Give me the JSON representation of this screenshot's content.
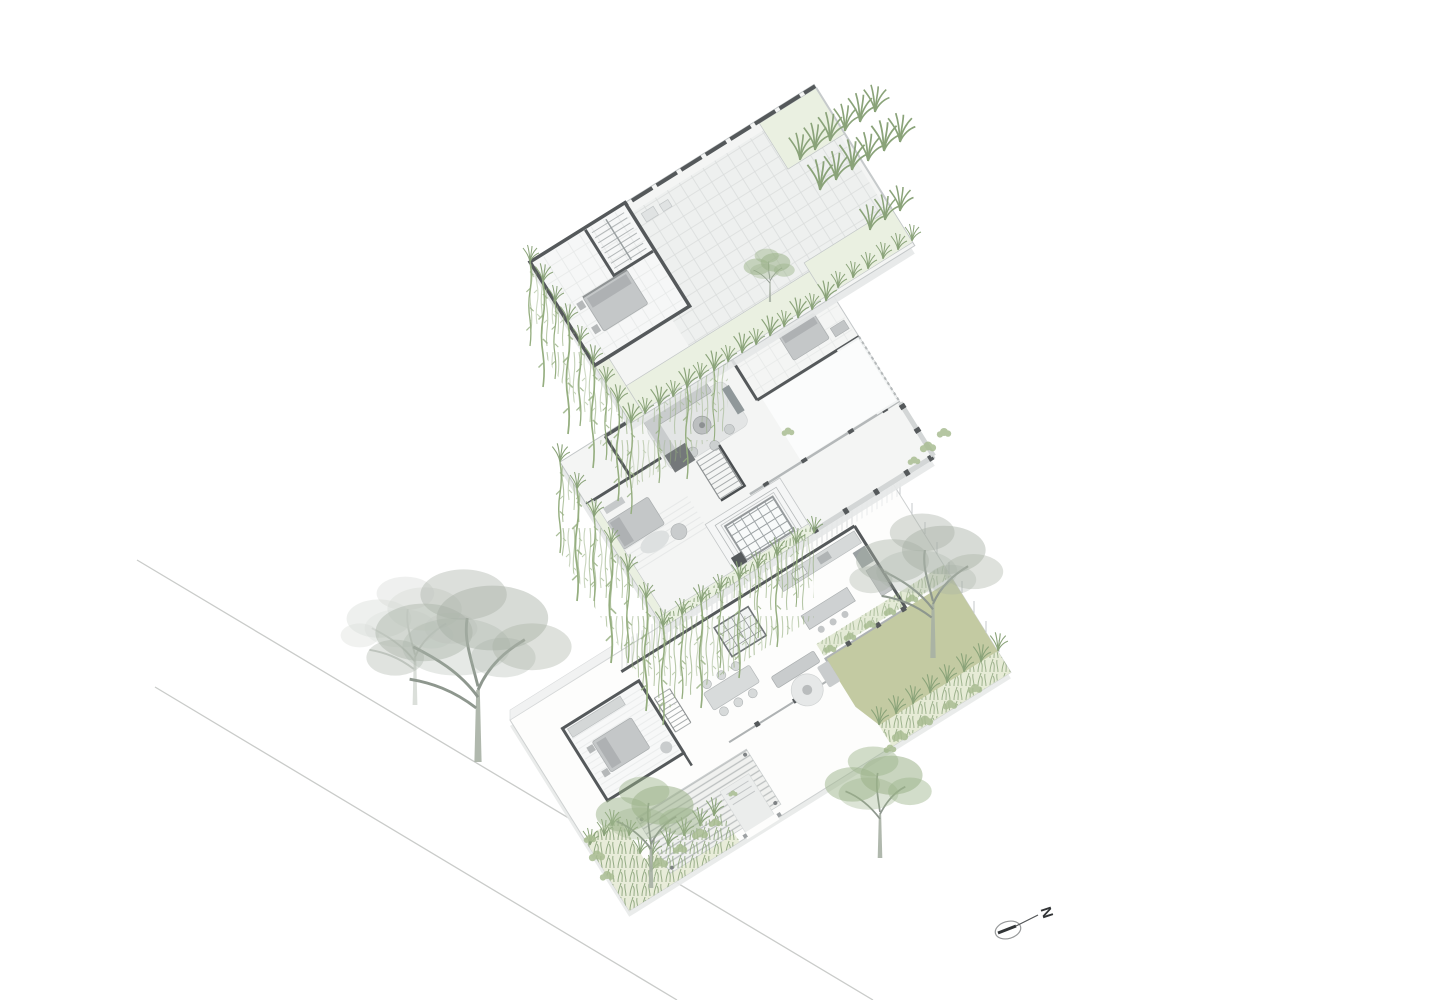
{
  "meta": {
    "drawing_type": "exploded-axonometric-floor-plan-diagram",
    "projection": "planometric",
    "background": "#ffffff"
  },
  "north_arrow": {
    "label": "N"
  },
  "levels": [
    {
      "id": "roof-terrace",
      "position": "top",
      "features": [
        "stair-bulkhead-bedroom",
        "paved-roof-deck",
        "back-parapet",
        "perimeter-planters",
        "ornamental-grasses",
        "hanging-vines",
        "roof-tree"
      ]
    },
    {
      "id": "first-floor",
      "position": "middle",
      "features": [
        "family-lounge",
        "rear-bedroom",
        "left-bedroom",
        "stair-core",
        "skylight-court",
        "balcony",
        "planter-with-hanging-vines",
        "double-height-deck"
      ]
    },
    {
      "id": "ground-floor",
      "position": "bottom",
      "features": [
        "bedroom",
        "open-kitchen",
        "dining-area",
        "living-area",
        "entry-steps",
        "pergola-deck",
        "lawn",
        "garden-beds",
        "boundary-walls",
        "garden-trees"
      ]
    }
  ],
  "site": {
    "street_lines": 2,
    "trees": {
      "gray_sketch": 3,
      "green_leafy": 2,
      "roof_small": 1
    }
  },
  "palette": {
    "background": "#ffffff",
    "wall-dark": "#55595b",
    "wall-light": "#c6cacb",
    "slab-line": "#c3c7c8",
    "floor": "#f4f5f4",
    "paver": "#eef0ef",
    "paver-line": "#dadddc",
    "planter": "#eaf0e1",
    "bed": "#c4c7c8",
    "furn": "#c9cccd",
    "rug": "#e3e5e5",
    "lawn": "#c3caa2",
    "grass": "#8aa379",
    "vine": "#95ae7f",
    "shrub": "#a9bd92",
    "tree-gray": "#a7b0a4",
    "tree-bark": "#8e978e",
    "tree-green": "#9cb38a",
    "street": "#c9cbc9",
    "ink": "#323537"
  }
}
